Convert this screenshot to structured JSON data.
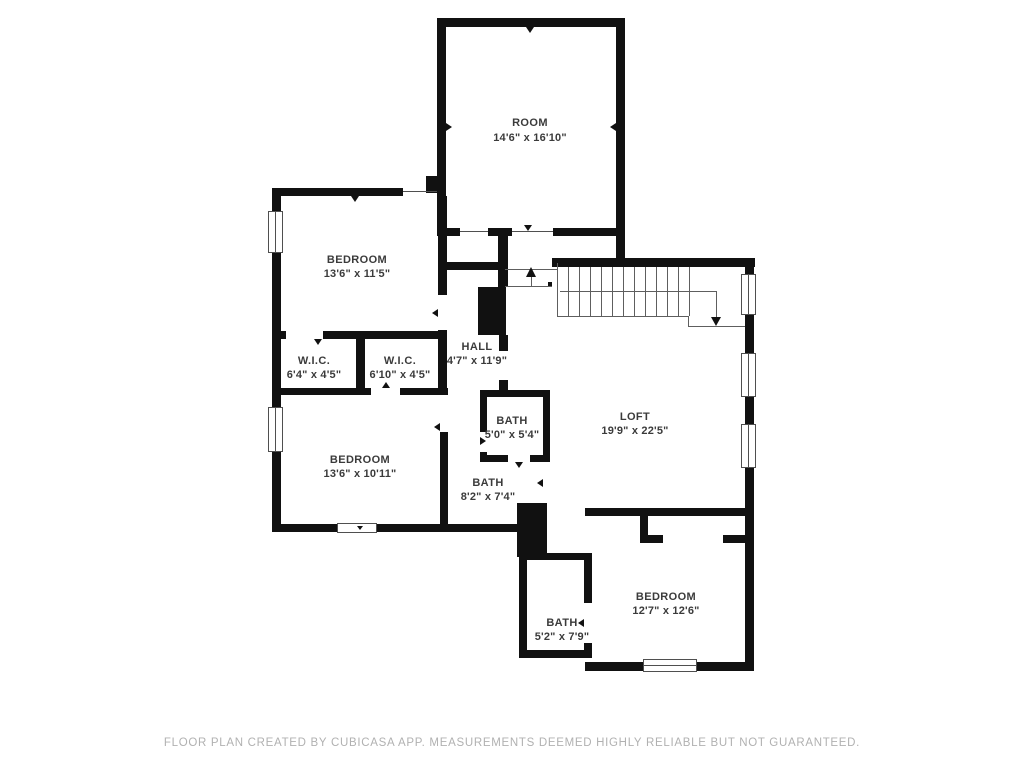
{
  "colors": {
    "wall": "#111111",
    "label": "#3b3b3b",
    "thin": "#4f4f4f",
    "stair": "#5e5e5e",
    "footer": "#b1b1b1",
    "bg": "#ffffff"
  },
  "rooms": [
    {
      "id": "room-top",
      "name": "ROOM",
      "dims": "14'6\" x 16'10\""
    },
    {
      "id": "bedroom-upper-left",
      "name": "BEDROOM",
      "dims": "13'6\" x 11'5\""
    },
    {
      "id": "wic-left",
      "name": "W.I.C.",
      "dims": "6'4\" x 4'5\""
    },
    {
      "id": "wic-right",
      "name": "W.I.C.",
      "dims": "6'10\" x 4'5\""
    },
    {
      "id": "hall",
      "name": "HALL",
      "dims": "4'7\" x 11'9\""
    },
    {
      "id": "bath-small",
      "name": "BATH",
      "dims": "5'0\" x 5'4\""
    },
    {
      "id": "loft",
      "name": "LOFT",
      "dims": "19'9\" x 22'5\""
    },
    {
      "id": "bedroom-lower-left",
      "name": "BEDROOM",
      "dims": "13'6\" x 10'11\""
    },
    {
      "id": "bath-center",
      "name": "BATH",
      "dims": "8'2\" x 7'4\""
    },
    {
      "id": "bath-bottom",
      "name": "BATH",
      "dims": "5'2\" x 7'9\""
    },
    {
      "id": "bedroom-bottom-right",
      "name": "BEDROOM",
      "dims": "12'7\" x 12'6\""
    }
  ],
  "footer": {
    "text": "FLOOR PLAN CREATED BY CUBICASA APP. MEASUREMENTS DEEMED HIGHLY RELIABLE BUT NOT GUARANTEED."
  }
}
